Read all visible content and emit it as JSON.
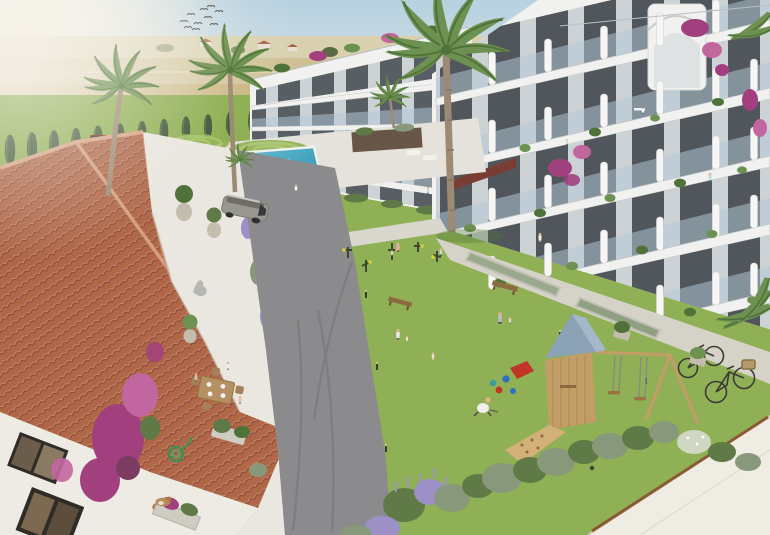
{
  "scene": {
    "title": "Aerial architectural rendering of a Mediterranean residential complex",
    "description": "Bird's-eye 3D visualization: white modern apartment blocks with glass balconies around a landscaped courtyard with lawn, swimming pool, outdoor gym, wooden playground with swing set, curved internal road with an SUV, a terracotta-roofed villa with dining terrace in the foreground, palm trees, cypress hedge, country road with trucks and golden fields behind, birds in a hazy sky.",
    "objects": [
      {
        "name": "sky",
        "label": "hazy blue sky with sun glare"
      },
      {
        "name": "birds-flock",
        "label": "flock of birds"
      },
      {
        "name": "fields",
        "label": "golden farmland with distant houses"
      },
      {
        "name": "country-road",
        "label": "road with grey truck, white box truck and red car"
      },
      {
        "name": "cypress-hedge",
        "label": "row of cypress trees along perimeter wall"
      },
      {
        "name": "left-apartment-building",
        "label": "white apartment wing with balconies"
      },
      {
        "name": "right-apartment-building",
        "label": "white apartment block with glass balconies, plants and bougainvillea"
      },
      {
        "name": "rooftop-stair",
        "label": "curved rooftop stair volume with bougainvillea"
      },
      {
        "name": "swimming-pool",
        "label": "pool with swimmers and deck"
      },
      {
        "name": "planter-box",
        "label": "dark raised planter with palm"
      },
      {
        "name": "suv-car",
        "label": "silver SUV on internal road"
      },
      {
        "name": "petanque-court",
        "label": "sand court"
      },
      {
        "name": "outdoor-gym",
        "label": "exercise machines on lawn"
      },
      {
        "name": "central-lawn",
        "label": "large green lawn with people"
      },
      {
        "name": "playground",
        "label": "wooden play tower with blue roof, climbing ramp and swings"
      },
      {
        "name": "toys",
        "label": "buckets, balls and red slide"
      },
      {
        "name": "walkway",
        "label": "concrete walkway with two bicycles"
      },
      {
        "name": "villa",
        "label": "terracotta-roof villa with terrace, dining family, cat, hose and bougainvillea"
      },
      {
        "name": "shrub-border",
        "label": "shrubs and lavender border"
      },
      {
        "name": "foreground-roof",
        "label": "white flat roof corner"
      }
    ],
    "people_visible": 22,
    "vehicles": [
      "grey truck",
      "white box truck",
      "red car",
      "silver SUV",
      "2 bicycles"
    ]
  },
  "colors": {
    "sky_top": "#b7d1e0",
    "sky_low": "#e8ecE9",
    "sun_glow": "#fffbe9",
    "haze": "#f6f2ea",
    "field_far": "#d8d0ae",
    "field_mid": "#cfc094",
    "field_gold": "#c6b077",
    "field_dark": "#b49c62",
    "tree_dark": "#5a6b44",
    "cypress": "#40573a",
    "cypress_hi": "#5d7848",
    "far_road": "#9b9a96",
    "wall_white": "#e9e7df",
    "lawn": "#8fb054",
    "lawn_hi": "#a7c569",
    "lawn_lo": "#74984a",
    "asphalt": "#8b8a8c",
    "tire": "#6e6d71",
    "path": "#d9d6cd",
    "walkway": "#d5d2c8",
    "deck": "#e4e2da",
    "pool": "#62bcd4",
    "pool_deep": "#3f9fba",
    "pool_hi": "#abe3ec",
    "bldg": "#f1f1ef",
    "bldg_shade": "#dcdedd",
    "slab_edge": "#c2c7ca",
    "recess": "#cdd2d5",
    "win": "#3a4147",
    "glass": "#b5c9d6",
    "pier": "#f6f6f4",
    "roof_tile": "#b06748",
    "tile_hi": "#c98d6e",
    "tile_lo": "#8c4a38",
    "ridge": "#d6a284",
    "terrace": "#eae7e0",
    "villa_wall": "#eeebe4",
    "frame_dark": "#2f2b27",
    "wood": "#c29e66",
    "wood_dk": "#97743f",
    "play_roof": "#8ba2b7",
    "play_roof_hi": "#a5b8c9",
    "bougain": "#a23f7e",
    "bougain_hi": "#c2669f",
    "palm": "#6d9150",
    "palm_dk": "#4f7239",
    "trunk": "#9d8a74",
    "shrub": "#5f7a47",
    "shrub_grey": "#87997a",
    "lavender": "#9c90c6",
    "sand": "#d7c190",
    "sand_dk": "#c3a86f",
    "skin": "#e5b28c",
    "red_car": "#ae2f24",
    "suv": "#98978f",
    "suv_dk": "#6e6d66",
    "truck_w": "#ededeb",
    "truck_g": "#8e8f91",
    "white_roof": "#efece3",
    "edging": "#8a5a33",
    "bench": "#8d6a3f",
    "awning": "#7a3d33"
  }
}
